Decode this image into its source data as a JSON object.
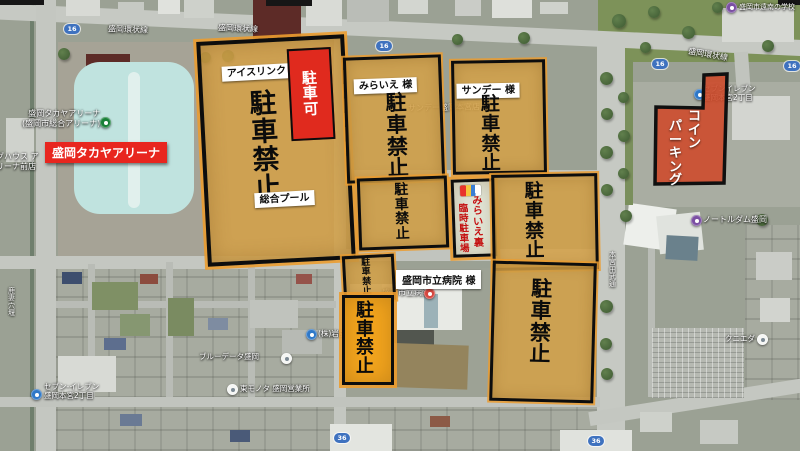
{
  "roads": {
    "ring": "盛岡環状線",
    "r16": "16",
    "r36": "36"
  },
  "pois": {
    "arena1": "盛岡タカヤアリーナ",
    "arena2": "(盛岡市総合アリーナ)",
    "doghouse1": "グハウス ア",
    "doghouse2": "リーナ前店",
    "canal": "鹿妻穴堰",
    "seven_sw1": "セブン-イレブン",
    "seven_sw2": "盛岡本宮2丁目",
    "bluedata": "ブルーデータ盛岡",
    "kabu": "(株)岩舘",
    "sales_office": "東モノタ 盛岡営業所",
    "sunday_store": "サンデー盛岡本宮店",
    "hospital": "盛岡市立病院",
    "seven_ne1": "セブンイレブン",
    "seven_ne2": "盛岡本宮2丁目",
    "notredame": "ノートルダム盛岡",
    "kunieda": "クニエダ",
    "school_ne": "盛岡市遠南の学校",
    "street_v": "本宮田武通"
  },
  "overlay": {
    "no_parking": "駐車禁止",
    "arena_banner": "盛岡タカヤアリーナ",
    "ice_rink": "アイスリンク",
    "parking_ok": "駐車可",
    "pool": "総合プール",
    "miraie_tag": "みらいえ 様",
    "sunday_tag": "サンデー 様",
    "temp1": "みらいえ裏",
    "temp2": "臨時駐車場",
    "hospital_tag": "盛岡市立病院 様",
    "coin1": "コイン",
    "coin2": "パーキング"
  },
  "colors": {
    "zone_fill": "#d5a147",
    "zone_border": "#0d0d0d",
    "ok_red": "#e02a1e",
    "banner_red": "#e8261f",
    "yellow_zone": "#f2a41d",
    "coin_red": "#ce4929",
    "temp_text": "#c40f0f"
  }
}
